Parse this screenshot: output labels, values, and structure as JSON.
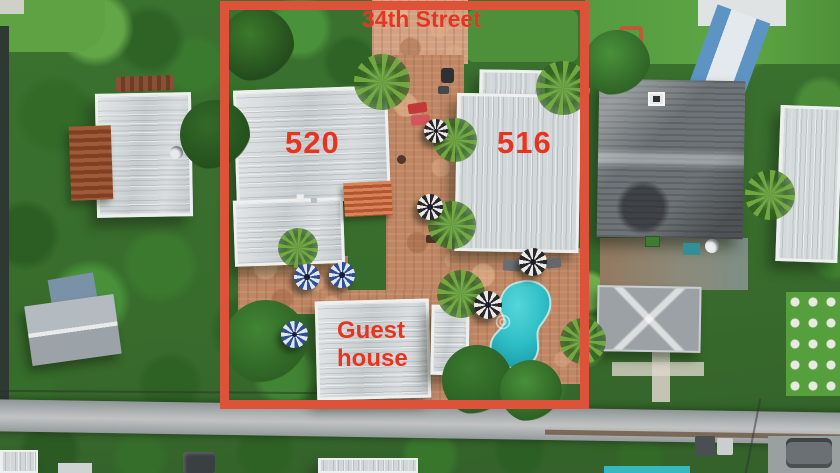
{
  "scene": {
    "type": "annotated aerial real-estate photo",
    "description": "Drone top-down view of a double-lot property outlined in red, with two main houses, a guest house, courtyard with umbrellas and a kidney-shaped pool"
  },
  "annotations": {
    "street_name": "34th Street",
    "left_building_number": "520",
    "right_building_number": "516",
    "guest_house_line1": "Guest",
    "guest_house_line2": "house",
    "outline_color": "#de5239",
    "label_color": "#e73420"
  },
  "palette": {
    "vegetation_green": "#3a7230",
    "paver_terracotta": "#c08764",
    "pool_turquoise": "#2fbec6",
    "roof_light_gray": "#d2d7d9",
    "roof_dark_gray": "#6d7377",
    "street_gray": "#a3a8a9",
    "umbrella_navy": "#2e4f93",
    "umbrella_black": "#26262b"
  }
}
